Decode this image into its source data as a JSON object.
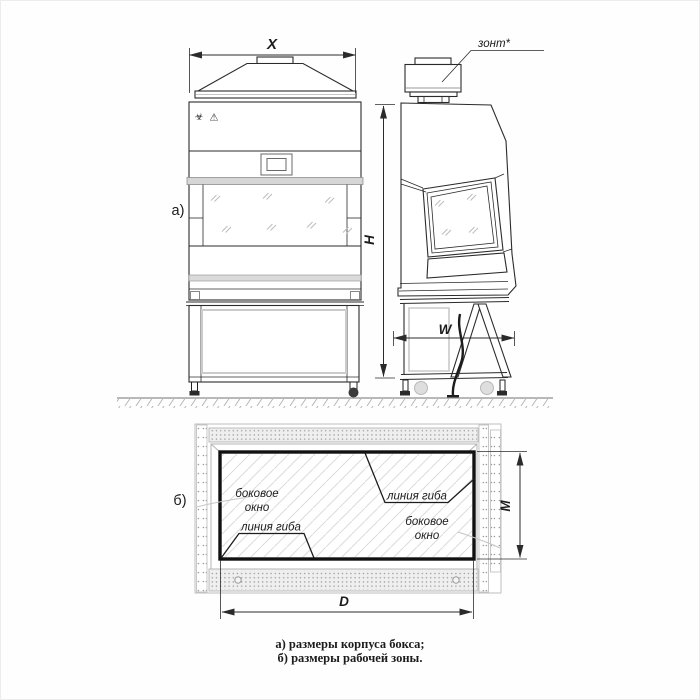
{
  "labels": {
    "dim_x": "X",
    "dim_h": "H",
    "dim_w": "W",
    "dim_m": "M",
    "dim_d": "D",
    "view_a": "а)",
    "view_b": "б)"
  },
  "annotations": {
    "hood": "зонт*",
    "side_window_line1": "боковое",
    "side_window_line2": "окно",
    "bend_line": "линия гиба"
  },
  "icons": {
    "biohazard": "☣",
    "warning": "⚠"
  },
  "caption": {
    "line_a": "а) размеры корпуса бокса;",
    "line_b": "б) размеры рабочей зоны."
  },
  "colors": {
    "ink": "#2b2b2b",
    "thick_outline": "#111111",
    "light_gray": "#c9c9c9",
    "band_fill": "#efefef"
  }
}
